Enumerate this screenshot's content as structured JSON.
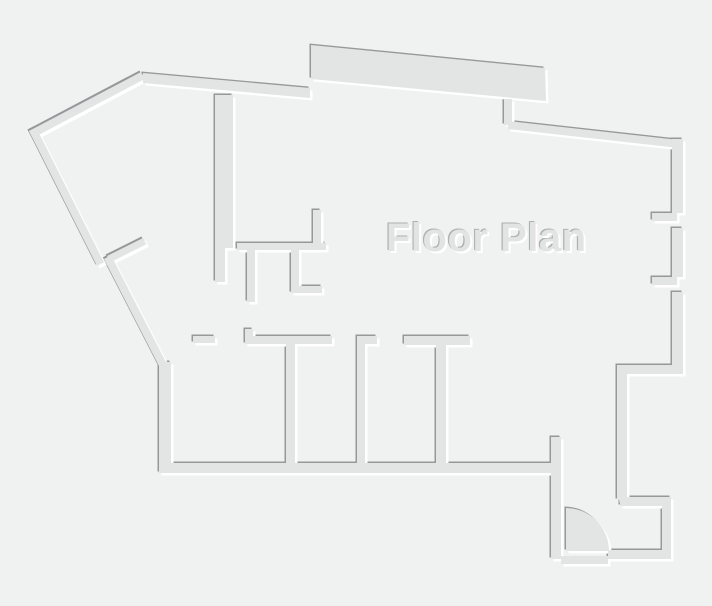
{
  "title": "Floor Plan",
  "colors": {
    "background": "#f0f1f1",
    "wall_fill": "#e3e5e5",
    "edge_dark": "#96989a",
    "edge_highlight": "#ffffff",
    "title_fill": "#e2e4e4",
    "title_shadow_dark": "#aeb1b1",
    "title_shadow_light": "#ffffff"
  }
}
